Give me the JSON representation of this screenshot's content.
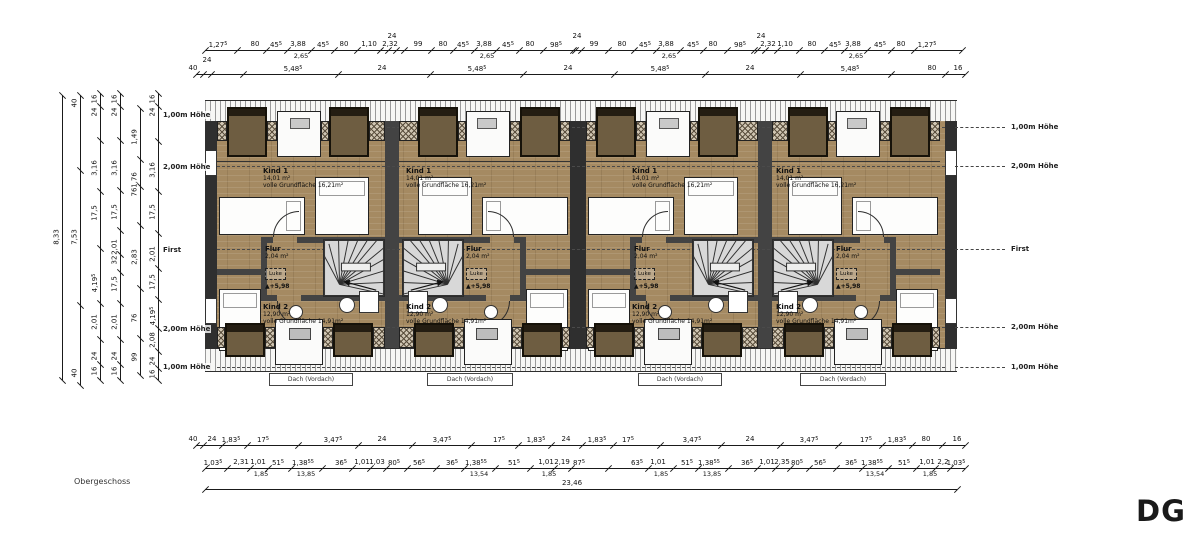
{
  "plan": {
    "floor_label": "Obergeschoss",
    "sheet_label": "DG",
    "rooms": {
      "kind1": {
        "name": "Kind 1",
        "area": "14,01 m²",
        "full": "volle Grundfläche 16,21m²"
      },
      "flur": {
        "name": "Flur",
        "area": "2,04 m²",
        "hatch_label": "Luke",
        "level_mark": "+5,98"
      },
      "kind2": {
        "name": "Kind 2",
        "area": "12,90 m²",
        "full": "volle Grundfläche 14,91m²"
      },
      "dach_label": "Dach (Vordach)"
    },
    "units": [
      {
        "x": 217,
        "w": 168,
        "mirror": false
      },
      {
        "x": 399,
        "w": 171,
        "mirror": true
      },
      {
        "x": 586,
        "w": 172,
        "mirror": false
      },
      {
        "x": 772,
        "w": 168,
        "mirror": true
      }
    ],
    "dach_boxes": [
      {
        "x": 269,
        "w": 84
      },
      {
        "x": 427,
        "w": 86
      },
      {
        "x": 638,
        "w": 84
      },
      {
        "x": 800,
        "w": 86
      }
    ],
    "height_labels_right": [
      {
        "y": 127,
        "t": "1,00m Höhe"
      },
      {
        "y": 166,
        "t": "2,00m Höhe"
      },
      {
        "y": 249,
        "t": "First"
      },
      {
        "y": 327,
        "t": "2,00m Höhe"
      },
      {
        "y": 367,
        "t": "1,00m Höhe"
      }
    ],
    "height_labels_left": [
      {
        "y": 115,
        "t": "1,00m Höhe"
      },
      {
        "y": 167,
        "t": "2,00m Höhe"
      },
      {
        "y": 250,
        "t": "First"
      },
      {
        "y": 329,
        "t": "2,00m Höhe"
      },
      {
        "y": 367,
        "t": "1,00m Höhe"
      }
    ],
    "height_line_ys": [
      127,
      166,
      249,
      327,
      367
    ]
  },
  "dimensions": {
    "top_rows": [
      {
        "y": 50,
        "x0": 205,
        "x1": 962,
        "tokens": [
          {
            "x": 218,
            "t": "1,27",
            "s": "5"
          },
          {
            "x": 255,
            "t": "80"
          },
          {
            "x": 276,
            "t": "45",
            "s": "5"
          },
          {
            "x": 298,
            "t": "3,88",
            "b": "2,65"
          },
          {
            "x": 323,
            "t": "45",
            "s": "5"
          },
          {
            "x": 344,
            "t": "80"
          },
          {
            "x": 369,
            "t": "1,10"
          },
          {
            "x": 390,
            "t": "2,32"
          },
          {
            "x": 392,
            "t": "24",
            "up": true
          },
          {
            "x": 418,
            "t": "99"
          },
          {
            "x": 443,
            "t": "80"
          },
          {
            "x": 463,
            "t": "45",
            "s": "5"
          },
          {
            "x": 484,
            "t": "3,88",
            "b": "2,65"
          },
          {
            "x": 508,
            "t": "45",
            "s": "5"
          },
          {
            "x": 530,
            "t": "80"
          },
          {
            "x": 556,
            "t": "98",
            "s": "5"
          },
          {
            "x": 577,
            "t": "24",
            "up": true
          },
          {
            "x": 594,
            "t": "99"
          },
          {
            "x": 622,
            "t": "80"
          },
          {
            "x": 645,
            "t": "45",
            "s": "5"
          },
          {
            "x": 666,
            "t": "3,88",
            "b": "2,65"
          },
          {
            "x": 693,
            "t": "45",
            "s": "5"
          },
          {
            "x": 713,
            "t": "80"
          },
          {
            "x": 740,
            "t": "98",
            "s": "5"
          },
          {
            "x": 761,
            "t": "24",
            "up": true
          },
          {
            "x": 768,
            "t": "2,32"
          },
          {
            "x": 785,
            "t": "1,10"
          },
          {
            "x": 812,
            "t": "80"
          },
          {
            "x": 835,
            "t": "45",
            "s": "5"
          },
          {
            "x": 853,
            "t": "3,88",
            "b": "2,65"
          },
          {
            "x": 880,
            "t": "45",
            "s": "5"
          },
          {
            "x": 901,
            "t": "80"
          },
          {
            "x": 927,
            "t": "1,27",
            "s": "5"
          }
        ]
      },
      {
        "y": 74,
        "x0": 196,
        "x1": 965,
        "tokens": [
          {
            "x": 193,
            "t": "40"
          },
          {
            "x": 207,
            "t": "24",
            "up": true
          },
          {
            "x": 293,
            "t": "5,48",
            "s": "5"
          },
          {
            "x": 382,
            "t": "24"
          },
          {
            "x": 477,
            "t": "5,48",
            "s": "5"
          },
          {
            "x": 568,
            "t": "24"
          },
          {
            "x": 660,
            "t": "5,48",
            "s": "5"
          },
          {
            "x": 750,
            "t": "24"
          },
          {
            "x": 850,
            "t": "5,48",
            "s": "5"
          },
          {
            "x": 932,
            "t": "80"
          },
          {
            "x": 958,
            "t": "16"
          }
        ]
      }
    ],
    "bottom_rows": [
      {
        "y": 445,
        "x0": 196,
        "x1": 965,
        "tokens": [
          {
            "x": 193,
            "t": "40"
          },
          {
            "x": 212,
            "t": "24"
          },
          {
            "x": 231,
            "t": "1,83",
            "s": "5"
          },
          {
            "x": 263,
            "t": "17",
            "s": "5"
          },
          {
            "x": 333,
            "t": "3,47",
            "s": "5"
          },
          {
            "x": 382,
            "t": "24"
          },
          {
            "x": 442,
            "t": "3,47",
            "s": "5"
          },
          {
            "x": 499,
            "t": "17",
            "s": "5"
          },
          {
            "x": 536,
            "t": "1,83",
            "s": "5"
          },
          {
            "x": 566,
            "t": "24"
          },
          {
            "x": 597,
            "t": "1,83",
            "s": "5"
          },
          {
            "x": 628,
            "t": "17",
            "s": "5"
          },
          {
            "x": 692,
            "t": "3,47",
            "s": "5"
          },
          {
            "x": 750,
            "t": "24"
          },
          {
            "x": 809,
            "t": "3,47",
            "s": "5"
          },
          {
            "x": 866,
            "t": "17",
            "s": "5"
          },
          {
            "x": 897,
            "t": "1,83",
            "s": "5"
          },
          {
            "x": 926,
            "t": "80"
          },
          {
            "x": 957,
            "t": "16"
          }
        ]
      },
      {
        "y": 468,
        "x0": 205,
        "x1": 965,
        "tokens": [
          {
            "x": 213,
            "t": "1,03",
            "s": "5"
          },
          {
            "x": 241,
            "t": "2,31"
          },
          {
            "x": 258,
            "t": "1,01",
            "b": "1,85"
          },
          {
            "x": 278,
            "t": "51",
            "s": "5"
          },
          {
            "x": 303,
            "t": "1,38",
            "s": "55",
            "b": "13,85"
          },
          {
            "x": 341,
            "t": "36",
            "s": "5"
          },
          {
            "x": 362,
            "t": "1,01"
          },
          {
            "x": 377,
            "t": "1,03"
          },
          {
            "x": 394,
            "t": "80",
            "s": "5"
          },
          {
            "x": 419,
            "t": "56",
            "s": "5"
          },
          {
            "x": 452,
            "t": "36",
            "s": "5"
          },
          {
            "x": 476,
            "t": "1,38",
            "s": "55",
            "b": "13,54"
          },
          {
            "x": 514,
            "t": "51",
            "s": "5"
          },
          {
            "x": 546,
            "t": "1,01",
            "b": "1,85"
          },
          {
            "x": 562,
            "t": "2,19"
          },
          {
            "x": 579,
            "t": "87",
            "s": "5"
          },
          {
            "x": 637,
            "t": "63",
            "s": "5"
          },
          {
            "x": 658,
            "t": "1,01",
            "b": "1,85"
          },
          {
            "x": 687,
            "t": "51",
            "s": "5"
          },
          {
            "x": 709,
            "t": "1,38",
            "s": "55",
            "b": "13,85"
          },
          {
            "x": 747,
            "t": "36",
            "s": "5"
          },
          {
            "x": 767,
            "t": "1,01"
          },
          {
            "x": 782,
            "t": "2,35"
          },
          {
            "x": 797,
            "t": "80",
            "s": "5"
          },
          {
            "x": 820,
            "t": "56",
            "s": "5"
          },
          {
            "x": 851,
            "t": "36",
            "s": "5"
          },
          {
            "x": 872,
            "t": "1,38",
            "s": "55",
            "b": "13,54"
          },
          {
            "x": 904,
            "t": "51",
            "s": "5"
          },
          {
            "x": 927,
            "t": "1,01",
            "b": "1,85"
          },
          {
            "x": 943,
            "t": "2,2"
          },
          {
            "x": 956,
            "t": "1,03",
            "s": "5"
          }
        ]
      }
    ],
    "bottom_total": {
      "y": 489,
      "x0": 205,
      "x1": 957,
      "label": "23,46",
      "label_x": 572
    },
    "left_chains": [
      {
        "x": 62,
        "y0": 95,
        "y1": 380,
        "tokens": [
          {
            "y": 237,
            "t": "8,33"
          }
        ]
      },
      {
        "x": 80,
        "y0": 95,
        "y1": 385,
        "tokens": [
          {
            "y": 103,
            "t": "40"
          },
          {
            "y": 237,
            "t": "7,53"
          },
          {
            "y": 373,
            "t": "40"
          }
        ]
      },
      {
        "x": 100,
        "y0": 93,
        "y1": 380,
        "tokens": [
          {
            "y": 99,
            "t": "16"
          },
          {
            "y": 112,
            "t": "24"
          },
          {
            "y": 168,
            "t": "3,16"
          },
          {
            "y": 213,
            "t": "17,5"
          },
          {
            "y": 283,
            "t": "4,19",
            "s": "5"
          },
          {
            "y": 322,
            "t": "2,01"
          },
          {
            "y": 356,
            "t": "24"
          },
          {
            "y": 371,
            "t": "16"
          }
        ]
      },
      {
        "x": 120,
        "y0": 93,
        "y1": 380,
        "tokens": [
          {
            "y": 99,
            "t": "16"
          },
          {
            "y": 112,
            "t": "24"
          },
          {
            "y": 168,
            "t": "3,16"
          },
          {
            "y": 212,
            "t": "17,5"
          },
          {
            "y": 247,
            "t": "2,01"
          },
          {
            "y": 260,
            "t": "32"
          },
          {
            "y": 284,
            "t": "17,5"
          },
          {
            "y": 322,
            "t": "2,01"
          },
          {
            "y": 356,
            "t": "24"
          },
          {
            "y": 371,
            "t": "16"
          }
        ]
      },
      {
        "x": 140,
        "y0": 108,
        "y1": 375,
        "tokens": [
          {
            "y": 137,
            "t": "1,49"
          },
          {
            "y": 180,
            "t": "1,76"
          },
          {
            "y": 192,
            "t": "76"
          },
          {
            "y": 257,
            "t": "2,83"
          },
          {
            "y": 318,
            "t": "76"
          },
          {
            "y": 357,
            "t": "99"
          }
        ]
      },
      {
        "x": 158,
        "y0": 93,
        "y1": 380,
        "tokens": [
          {
            "y": 99,
            "t": "16"
          },
          {
            "y": 112,
            "t": "24"
          },
          {
            "y": 170,
            "t": "3,16"
          },
          {
            "y": 212,
            "t": "17,5"
          },
          {
            "y": 254,
            "t": "2,01"
          },
          {
            "y": 282,
            "t": "17,5"
          },
          {
            "y": 316,
            "t": "4,19",
            "s": "5"
          },
          {
            "y": 340,
            "t": "2,08"
          },
          {
            "y": 361,
            "t": "24"
          },
          {
            "y": 374,
            "t": "16"
          }
        ]
      }
    ]
  },
  "colors": {
    "wall": "#434343",
    "wall_dark": "#2f2f2f",
    "wood_floor": "#a58a62",
    "stair_fill": "#d8d8d8",
    "hatch_bg": "#cfc5b2",
    "dim_ink": "#1a1a1a"
  }
}
